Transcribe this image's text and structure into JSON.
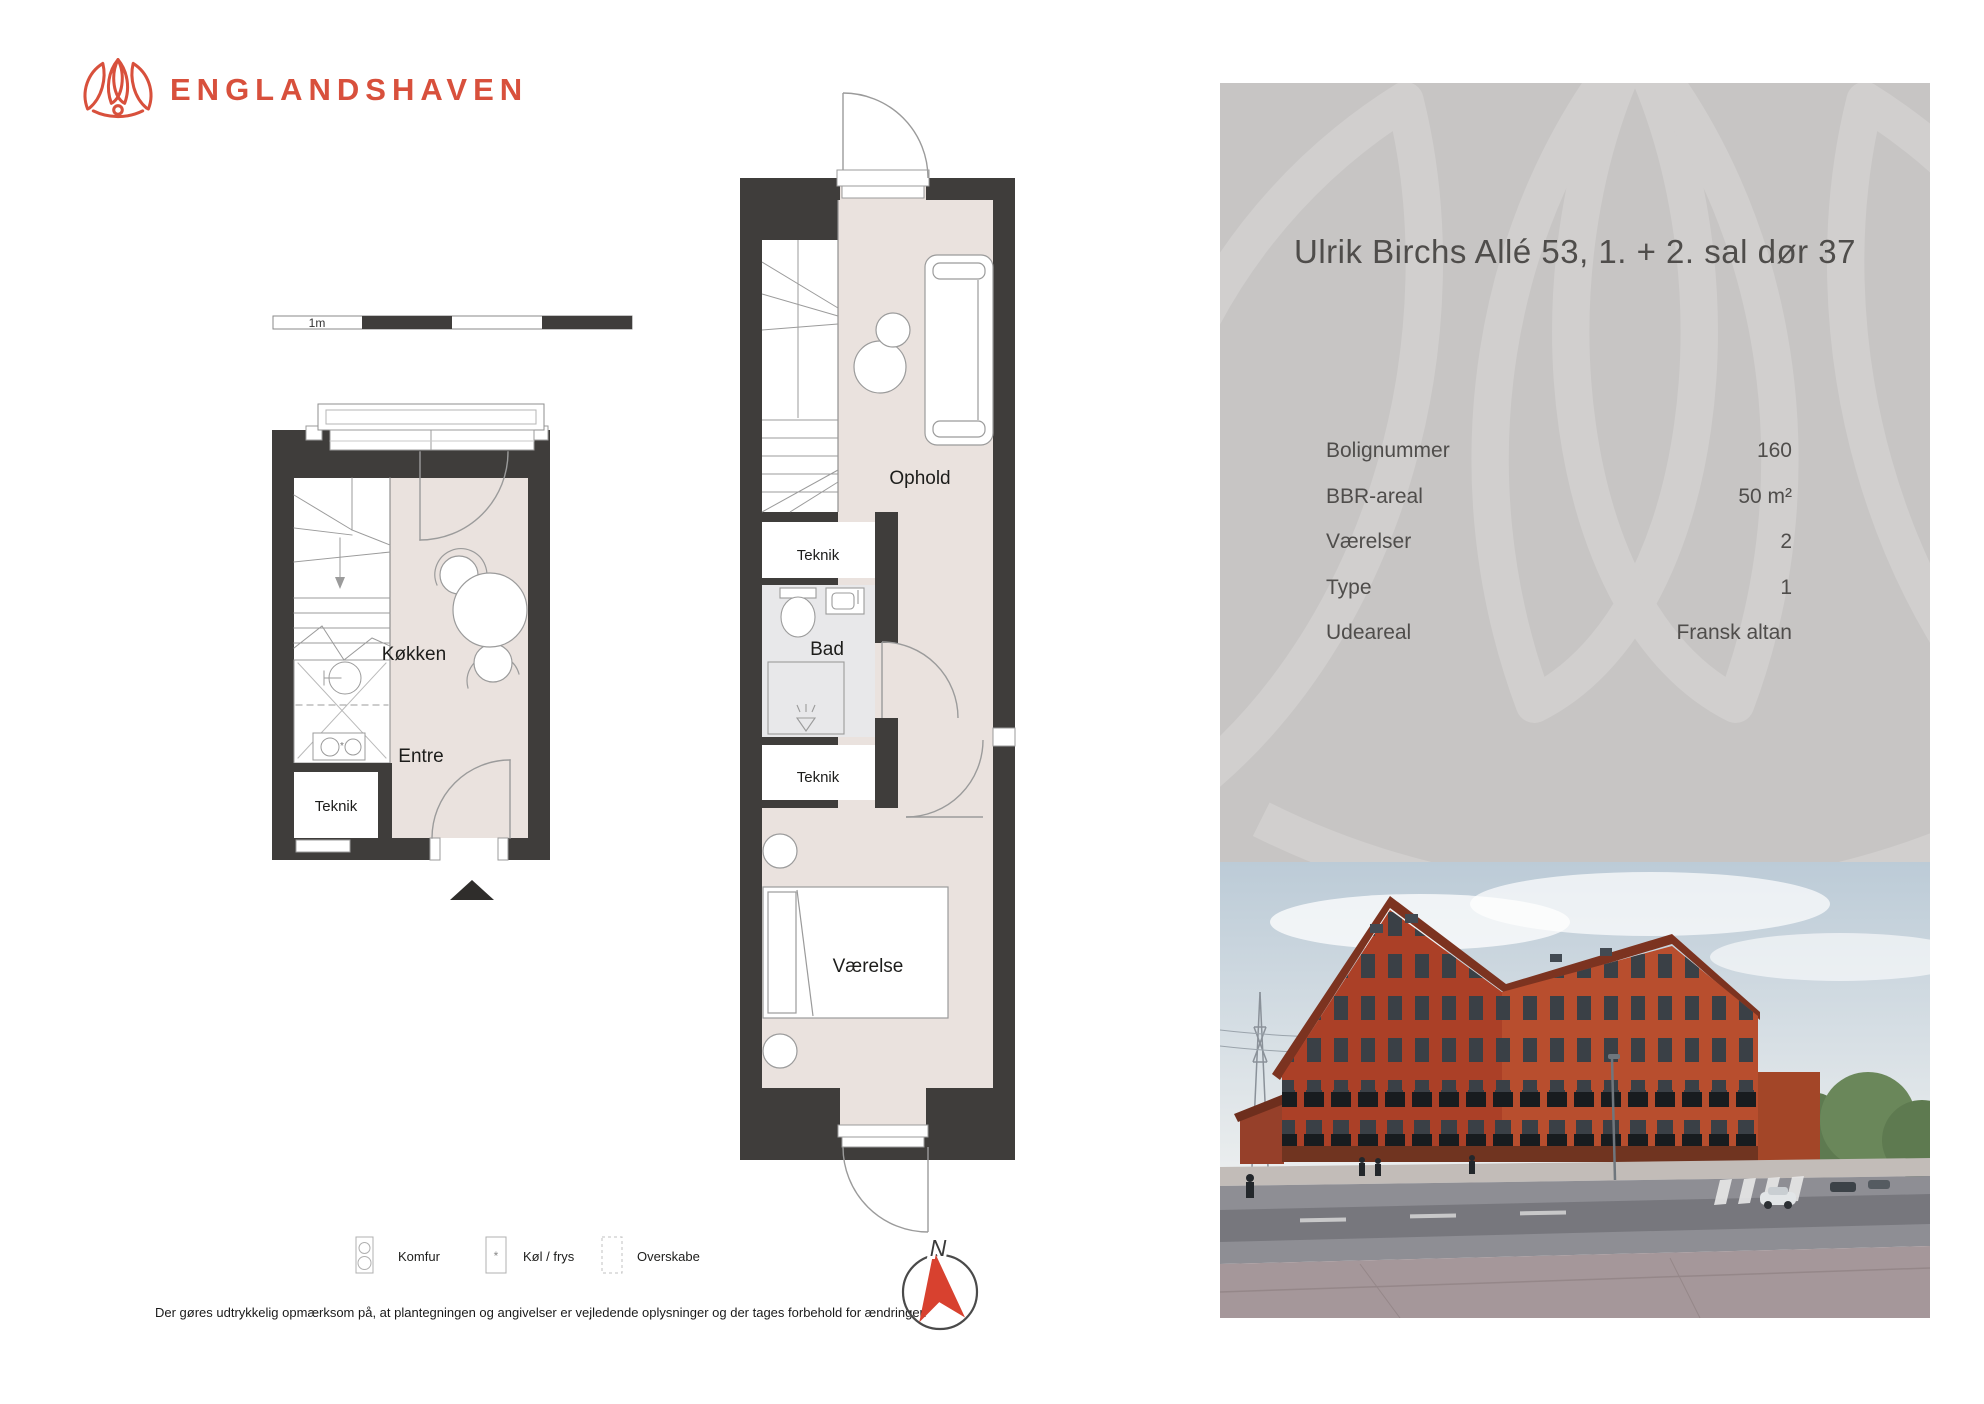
{
  "brand": {
    "name": "ENGLANDSHAVEN"
  },
  "plan": {
    "scale_label": "1m",
    "lower": {
      "kitchen": "Køkken",
      "entry": "Entre",
      "tech": "Teknik"
    },
    "upper": {
      "living": "Ophold",
      "tech_upper": "Teknik",
      "bath": "Bad",
      "tech_lower": "Teknik",
      "bedroom": "Værelse"
    }
  },
  "legend": {
    "stove": "Komfur",
    "fridge": "Køl / frys",
    "cabinets": "Overskabe",
    "fridge_symbol": "*"
  },
  "compass": {
    "north": "N"
  },
  "disclaimer": "Der gøres udtrykkelig opmærksom på, at plantegningen og angivelser er vejledende oplysninger og der tages forbehold for ændringer.",
  "info_panel": {
    "title": "Ulrik Birchs Allé 53, 1. + 2. sal dør 37",
    "rows": [
      {
        "label": "Bolignummer",
        "value": "160"
      },
      {
        "label": "BBR-areal",
        "value": "50 m²"
      },
      {
        "label": "Værelser",
        "value": "2"
      },
      {
        "label": "Type",
        "value": "1"
      },
      {
        "label": "Udeareal",
        "value": "Fransk altan"
      }
    ]
  },
  "colors": {
    "brand_red": "#d8503c",
    "wall": "#3f3d3b",
    "floor": "#eae2de",
    "bath_floor": "#e8e8ea",
    "panel_bg": "#c7c5c4",
    "panel_text": "#4f4d4b",
    "compass_red": "#d8412f"
  }
}
